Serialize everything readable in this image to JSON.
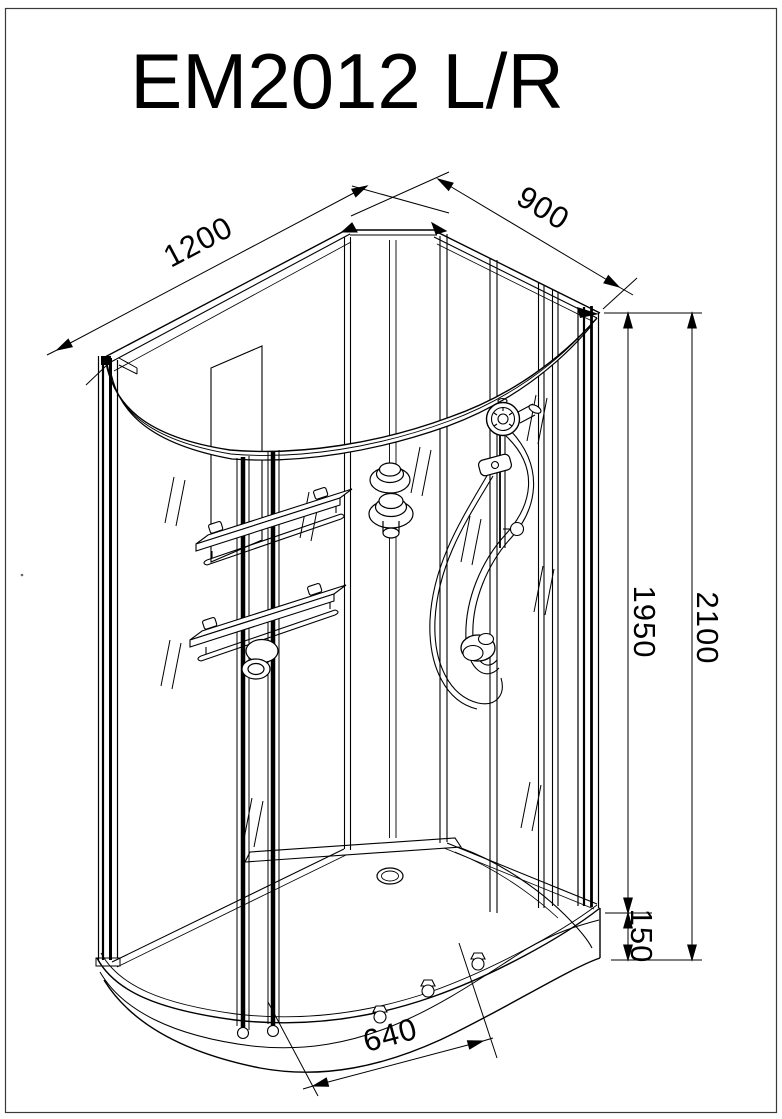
{
  "title": "EM2012 L/R",
  "drawing": {
    "kind": "isometric technical line drawing",
    "subject": "offset quadrant shower cabin with curved sliding doors, wall shelves, shower column and low tray"
  },
  "dim_labels": {
    "width": "1200",
    "depth": "900",
    "cabin_height": "1950",
    "total_height": "2100",
    "tray_height": "150",
    "entry_width": "640"
  },
  "colors": {
    "line": "#000000",
    "border": "#3a3a3a",
    "background": "#ffffff"
  }
}
